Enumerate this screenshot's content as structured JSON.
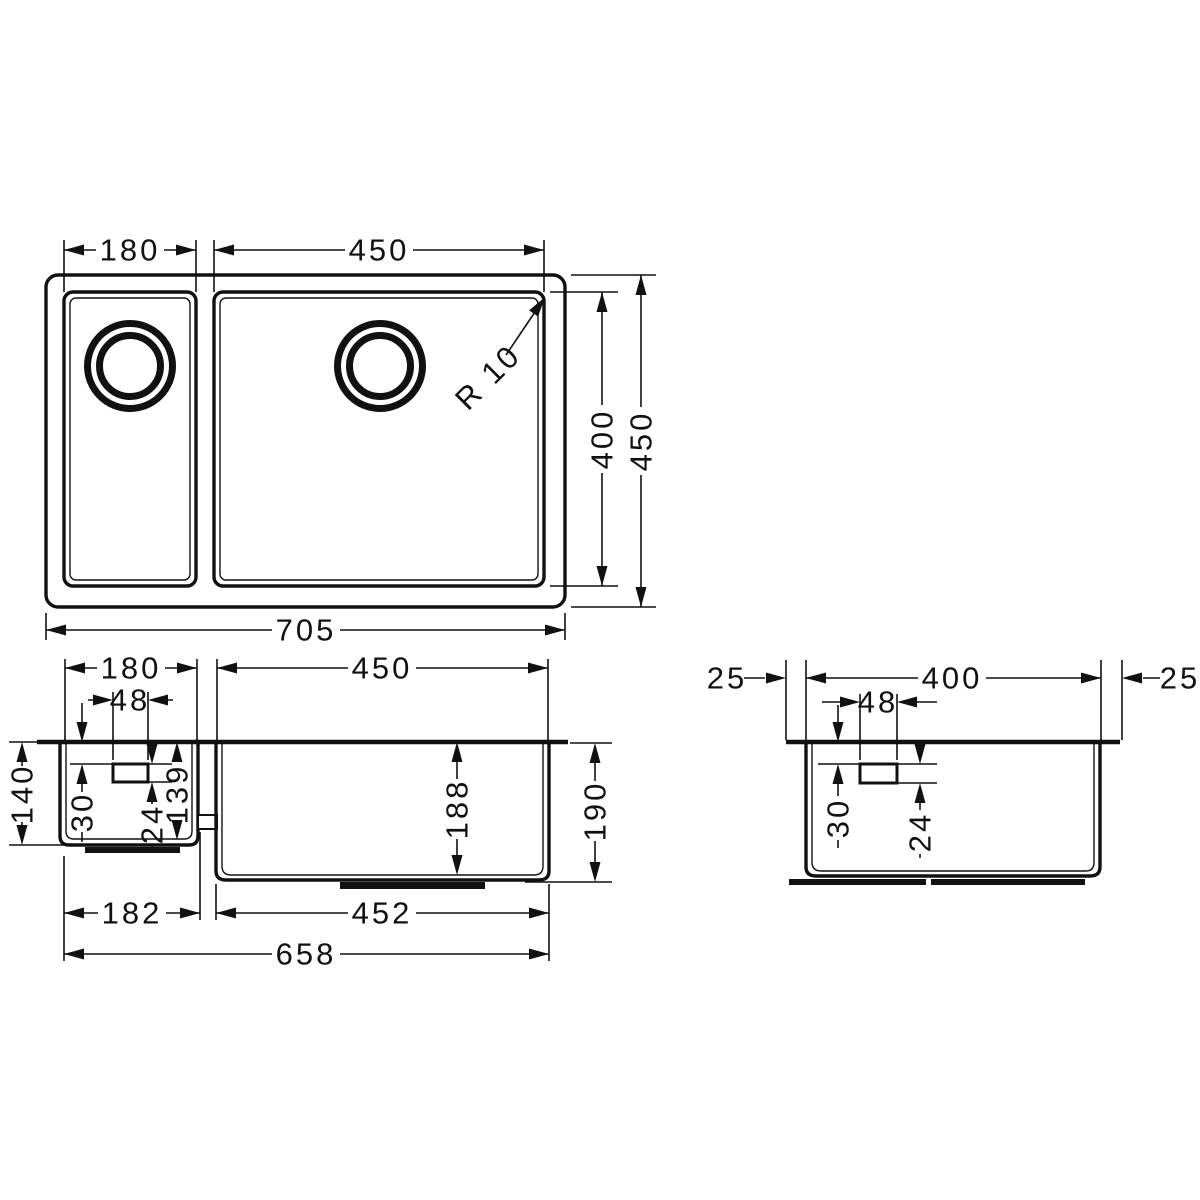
{
  "drawing": {
    "description": "Technical dimension drawing of a 1.5-bowl undermount kitchen sink: plan view, front section view and side section view",
    "units": "mm",
    "plan": {
      "left_bowl_width": "180",
      "right_bowl_width": "450",
      "inner_length": "400",
      "outer_length": "450",
      "overall_width": "705",
      "corner_radius": "R 10"
    },
    "front": {
      "left_bowl_width": "180",
      "right_bowl_width": "450",
      "drain_width": "48",
      "left_outer_depth": "140",
      "drain_top_offset": "30",
      "drain_height": "24",
      "left_inner_depth": "139",
      "right_inner_depth": "188",
      "right_outer_depth": "190",
      "left_bottom_width": "182",
      "right_bottom_width": "452",
      "overall_bottom_width": "658"
    },
    "side": {
      "front_rim": "25",
      "bowl_length": "400",
      "back_rim": "25",
      "drain_width": "48",
      "drain_top_offset": "30",
      "drain_height": "24"
    }
  }
}
